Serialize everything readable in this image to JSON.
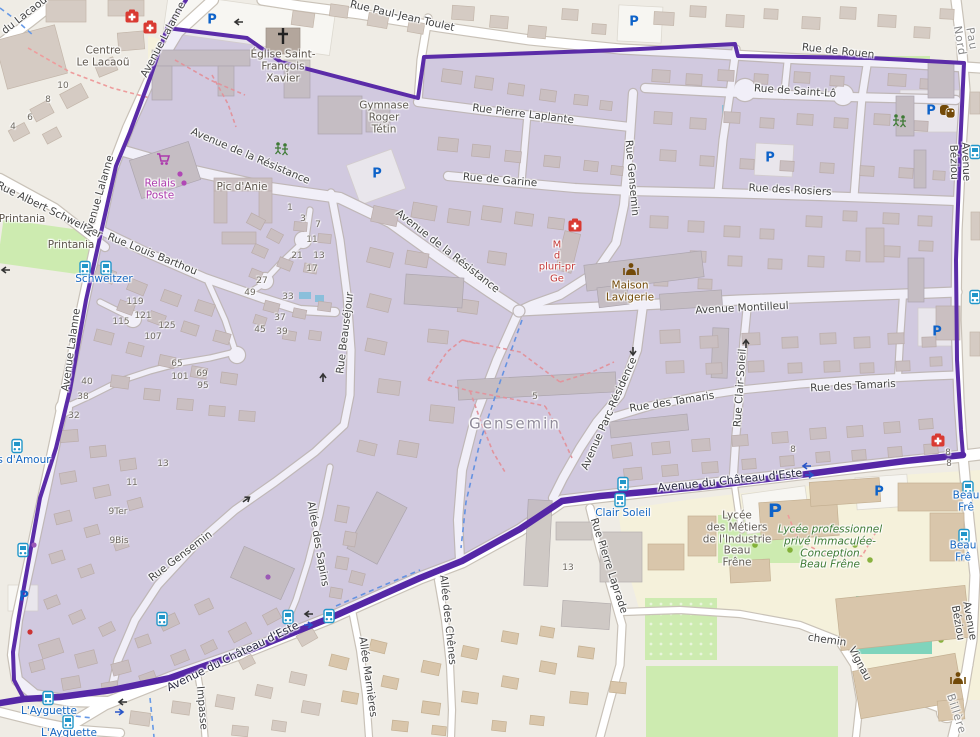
{
  "map": {
    "colors": {
      "boundary": "#5b2ca8",
      "region_fill": "#dcd6e4",
      "region_tint": "rgba(104,74,180,0.09)",
      "land": "#efece5",
      "road": "#ffffff",
      "road_casing": "#c9c2b8",
      "water": "#8ecbe0",
      "park": "#cdebb0",
      "pitch": "#7fd4bc",
      "school_area": "#f5f1db",
      "building": "#d5cbc3",
      "bus_blue": "#1566c0",
      "parking_blue": "#0d62c9",
      "health_red": "#d93a32",
      "shop_magenta": "#ac39ac",
      "poi_brown": "#734a08"
    },
    "street_labels": [
      {
        "text": "Rue Paul-Jean Toulet",
        "x": 402,
        "y": 17,
        "rot": 13,
        "kind": "street"
      },
      {
        "text": "Rue de Rouen",
        "x": 838,
        "y": 52,
        "rot": 6,
        "kind": "street"
      },
      {
        "text": "Rue de Saint-Lô",
        "x": 795,
        "y": 92,
        "rot": 4,
        "kind": "street"
      },
      {
        "text": "Rue Pierre Laplante",
        "x": 523,
        "y": 115,
        "rot": 7,
        "kind": "street"
      },
      {
        "text": "Rue de Garine",
        "x": 500,
        "y": 181,
        "rot": 5,
        "kind": "street"
      },
      {
        "text": "Rue des Rosiers",
        "x": 790,
        "y": 191,
        "rot": 3,
        "kind": "street"
      },
      {
        "text": "Avenue de la Résistance",
        "x": 250,
        "y": 157,
        "rot": 23,
        "kind": "street"
      },
      {
        "text": "Avenue de la Résistance",
        "x": 447,
        "y": 252,
        "rot": 38,
        "kind": "street"
      },
      {
        "text": "Rue Louis Barthou",
        "x": 152,
        "y": 255,
        "rot": 22,
        "kind": "street"
      },
      {
        "text": "Rue Albert Schweitzer",
        "x": 49,
        "y": 211,
        "rot": 26,
        "kind": "street"
      },
      {
        "text": "Avenue Montilleul",
        "x": 742,
        "y": 309,
        "rot": -3,
        "kind": "street"
      },
      {
        "text": "Rue des Tamaris",
        "x": 672,
        "y": 403,
        "rot": -9,
        "kind": "street"
      },
      {
        "text": "Rue des Tamaris",
        "x": 853,
        "y": 387,
        "rot": -3,
        "kind": "street"
      },
      {
        "text": "Avenue du Château d'Este",
        "x": 730,
        "y": 481,
        "rot": -6,
        "kind": "route"
      },
      {
        "text": "Avenue du Château d'Este",
        "x": 233,
        "y": 657,
        "rot": -26,
        "kind": "route"
      },
      {
        "text": "chemin",
        "x": 827,
        "y": 641,
        "rot": 8,
        "kind": "street"
      },
      {
        "text": "Vignau",
        "x": 859,
        "y": 664,
        "rot": 62,
        "kind": "street"
      },
      {
        "text": "Rue Gensemin",
        "x": 181,
        "y": 557,
        "rot": -37,
        "kind": "street"
      },
      {
        "text": "Rue Beauséjour",
        "x": 346,
        "y": 333,
        "rot": -83,
        "kind": "street"
      },
      {
        "text": "Rue Gensemin",
        "x": 631,
        "y": 178,
        "rot": 85,
        "kind": "street"
      },
      {
        "text": "Rue Clair-Soleil",
        "x": 741,
        "y": 388,
        "rot": -86,
        "kind": "street"
      },
      {
        "text": "Avenue Parc-Résidence",
        "x": 610,
        "y": 414,
        "rot": -66,
        "kind": "street"
      },
      {
        "text": "Allée des Sapins",
        "x": 317,
        "y": 544,
        "rot": 80,
        "kind": "street"
      },
      {
        "text": "Allée Marnières",
        "x": 367,
        "y": 677,
        "rot": 82,
        "kind": "street"
      },
      {
        "text": "Allée des Chênes",
        "x": 447,
        "y": 620,
        "rot": 84,
        "kind": "street"
      },
      {
        "text": "Rue Pierre Laprade",
        "x": 608,
        "y": 566,
        "rot": 72,
        "kind": "street"
      },
      {
        "text": "Avenue Lalanne",
        "x": 164,
        "y": 40,
        "rot": -62,
        "kind": "street"
      },
      {
        "text": "Avenue Lalanne",
        "x": 100,
        "y": 196,
        "rot": -74,
        "kind": "street"
      },
      {
        "text": "Avenue Lalanne",
        "x": 72,
        "y": 350,
        "rot": -82,
        "kind": "street"
      },
      {
        "text": "Avenue Béziou",
        "x": 959,
        "y": 162,
        "rot": 88,
        "kind": "street"
      },
      {
        "text": "Avenue Béziou",
        "x": 963,
        "y": 622,
        "rot": 80,
        "kind": "street"
      },
      {
        "text": "du Lacaou",
        "x": 25,
        "y": 16,
        "rot": -38,
        "kind": "street"
      },
      {
        "text": "Impasse",
        "x": 201,
        "y": 708,
        "rot": 85,
        "kind": "street"
      },
      {
        "text": "Pau Nord",
        "x": 965,
        "y": 40,
        "rot": 80,
        "kind": "district"
      },
      {
        "text": "Billère",
        "x": 956,
        "y": 714,
        "rot": 72,
        "kind": "district"
      }
    ],
    "place_labels": [
      {
        "lines": [
          "Centre",
          "Le Lacaoũ"
        ],
        "x": 103,
        "y": 57,
        "kind": "place"
      },
      {
        "lines": [
          "Église Saint-",
          "François",
          "Xavier"
        ],
        "x": 283,
        "y": 67,
        "kind": "place"
      },
      {
        "lines": [
          "Gymnase",
          "Roger",
          "Tétin"
        ],
        "x": 384,
        "y": 118,
        "kind": "school"
      },
      {
        "lines": [
          "Pic d'Anie"
        ],
        "x": 242,
        "y": 188,
        "kind": "place"
      },
      {
        "lines": [
          "Printania"
        ],
        "x": 22,
        "y": 220,
        "kind": "place"
      },
      {
        "lines": [
          "Printania"
        ],
        "x": 71,
        "y": 246,
        "kind": "place"
      },
      {
        "lines": [
          "Gensemin"
        ],
        "x": 515,
        "y": 424,
        "kind": "area-big"
      },
      {
        "lines": [
          "Relais",
          "Poste"
        ],
        "x": 160,
        "y": 190,
        "kind": "shop"
      },
      {
        "lines": [
          "Maison",
          "Lavigerie"
        ],
        "x": 630,
        "y": 292,
        "kind": "community"
      },
      {
        "lines": [
          "M",
          "d",
          "pluri-pr",
          "Ge"
        ],
        "x": 557,
        "y": 262,
        "kind": "health"
      },
      {
        "lines": [
          "Lycée",
          "des Métiers",
          "de l'Industrie",
          "Beau",
          "Frêne"
        ],
        "x": 737,
        "y": 540,
        "kind": "school"
      },
      {
        "lines": [
          "Lycée professionnel",
          "privé Immaculée-",
          "Conception",
          "Beau Frêne"
        ],
        "x": 830,
        "y": 548,
        "kind": "school-private"
      }
    ],
    "bus_stop_labels": [
      {
        "text": "Schweitzer",
        "x": 104,
        "y": 280
      },
      {
        "text": "s d'Amour",
        "x": 24,
        "y": 461
      },
      {
        "text": "Clair Soleil",
        "x": 623,
        "y": 514
      },
      {
        "text": "Beau Frê",
        "x": 966,
        "y": 502
      },
      {
        "text": "Beau Frê",
        "x": 963,
        "y": 552
      },
      {
        "text": "L'Ayguette",
        "x": 49,
        "y": 712
      },
      {
        "text": "L'Ayguette",
        "x": 69,
        "y": 734
      }
    ],
    "house_numbers": [
      {
        "n": "10",
        "x": 63,
        "y": 86
      },
      {
        "n": "8",
        "x": 48,
        "y": 100
      },
      {
        "n": "6",
        "x": 30,
        "y": 118
      },
      {
        "n": "4",
        "x": 13,
        "y": 127
      },
      {
        "n": "1",
        "x": 290,
        "y": 208
      },
      {
        "n": "3",
        "x": 303,
        "y": 219
      },
      {
        "n": "7",
        "x": 318,
        "y": 225
      },
      {
        "n": "11",
        "x": 312,
        "y": 240
      },
      {
        "n": "21",
        "x": 297,
        "y": 256
      },
      {
        "n": "13",
        "x": 319,
        "y": 256
      },
      {
        "n": "17",
        "x": 312,
        "y": 269
      },
      {
        "n": "27",
        "x": 262,
        "y": 281
      },
      {
        "n": "49",
        "x": 250,
        "y": 293
      },
      {
        "n": "33",
        "x": 288,
        "y": 297
      },
      {
        "n": "37",
        "x": 280,
        "y": 318
      },
      {
        "n": "45",
        "x": 260,
        "y": 330
      },
      {
        "n": "39",
        "x": 282,
        "y": 332
      },
      {
        "n": "119",
        "x": 135,
        "y": 302
      },
      {
        "n": "115",
        "x": 121,
        "y": 322
      },
      {
        "n": "121",
        "x": 143,
        "y": 316
      },
      {
        "n": "125",
        "x": 167,
        "y": 326
      },
      {
        "n": "107",
        "x": 153,
        "y": 337
      },
      {
        "n": "65",
        "x": 177,
        "y": 364
      },
      {
        "n": "101",
        "x": 180,
        "y": 377
      },
      {
        "n": "69",
        "x": 202,
        "y": 374
      },
      {
        "n": "95",
        "x": 203,
        "y": 386
      },
      {
        "n": "40",
        "x": 87,
        "y": 382
      },
      {
        "n": "38",
        "x": 83,
        "y": 397
      },
      {
        "n": "32",
        "x": 74,
        "y": 416
      },
      {
        "n": "13",
        "x": 163,
        "y": 464
      },
      {
        "n": "11",
        "x": 132,
        "y": 483
      },
      {
        "n": "9Ter",
        "x": 118,
        "y": 512
      },
      {
        "n": "9Bis",
        "x": 119,
        "y": 541
      },
      {
        "n": "5",
        "x": 535,
        "y": 397
      },
      {
        "n": "8",
        "x": 793,
        "y": 450
      },
      {
        "n": "8",
        "x": 948,
        "y": 453
      },
      {
        "n": "8",
        "x": 949,
        "y": 464
      },
      {
        "n": "13",
        "x": 568,
        "y": 568
      }
    ],
    "icons": {
      "parking": [
        {
          "x": 212,
          "y": 20
        },
        {
          "x": 634,
          "y": 22
        },
        {
          "x": 377,
          "y": 174
        },
        {
          "x": 770,
          "y": 158
        },
        {
          "x": 931,
          "y": 111
        },
        {
          "x": 937,
          "y": 332
        },
        {
          "x": 775,
          "y": 511,
          "big": true
        },
        {
          "x": 879,
          "y": 492
        },
        {
          "x": 24,
          "y": 597
        }
      ],
      "bus": [
        {
          "x": 85,
          "y": 268
        },
        {
          "x": 106,
          "y": 268
        },
        {
          "x": 17,
          "y": 446
        },
        {
          "x": 23,
          "y": 550
        },
        {
          "x": 48,
          "y": 698
        },
        {
          "x": 68,
          "y": 722
        },
        {
          "x": 162,
          "y": 619
        },
        {
          "x": 288,
          "y": 617
        },
        {
          "x": 329,
          "y": 616
        },
        {
          "x": 623,
          "y": 484
        },
        {
          "x": 620,
          "y": 500
        },
        {
          "x": 968,
          "y": 488
        },
        {
          "x": 964,
          "y": 536
        },
        {
          "x": 975,
          "y": 152
        },
        {
          "x": 975,
          "y": 297
        }
      ],
      "medical": [
        {
          "x": 132,
          "y": 17
        },
        {
          "x": 150,
          "y": 28
        },
        {
          "x": 575,
          "y": 226
        },
        {
          "x": 938,
          "y": 441
        }
      ],
      "church": [
        {
          "x": 283,
          "y": 36
        }
      ],
      "theatre": [
        {
          "x": 947,
          "y": 111
        }
      ],
      "community": [
        {
          "x": 631,
          "y": 269
        },
        {
          "x": 958,
          "y": 678
        }
      ],
      "playground": [
        {
          "x": 282,
          "y": 148
        },
        {
          "x": 900,
          "y": 120
        }
      ],
      "cart": [
        {
          "x": 163,
          "y": 159
        }
      ],
      "poi_dots": [
        {
          "x": 180,
          "y": 174,
          "c": "#b048b5"
        },
        {
          "x": 184,
          "y": 183,
          "c": "#b048b5"
        },
        {
          "x": 268,
          "y": 577,
          "c": "#9b59b6"
        },
        {
          "x": 34,
          "y": 545,
          "c": "#9b59b6"
        },
        {
          "x": 30,
          "y": 632,
          "c": "#cc3333"
        }
      ]
    }
  }
}
